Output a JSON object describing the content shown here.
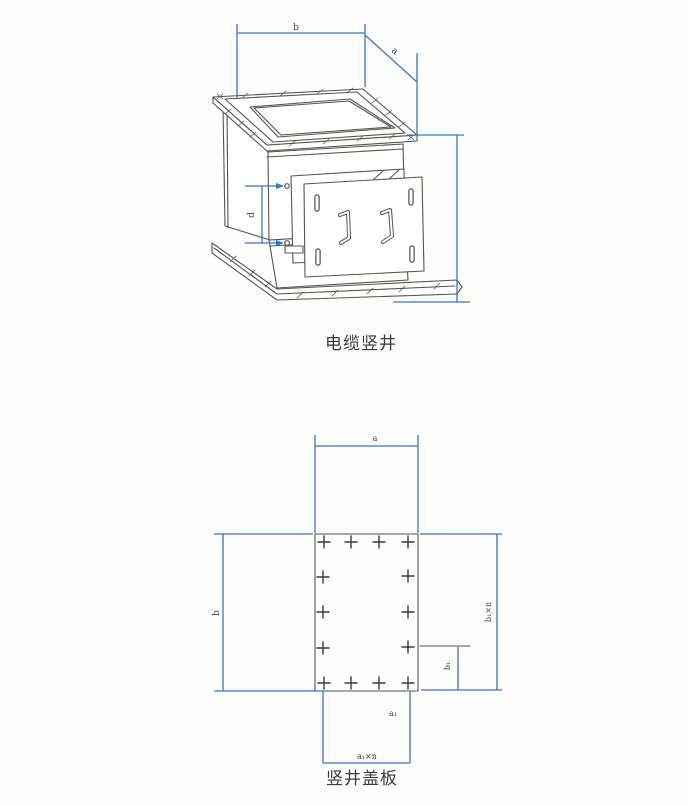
{
  "page": {
    "background": "#fdfdfb",
    "colors": {
      "dimension_blue": "#3578c8",
      "drawing_gray": "#56544f",
      "label_text": "#3e3e3c"
    }
  },
  "figure_top": {
    "caption": "电缆竖井",
    "dim_labels": {
      "top_width": "b",
      "top_depth": "a",
      "door_bolt_spacing": "d"
    }
  },
  "figure_bottom": {
    "caption": "竖井盖板",
    "dim_labels": {
      "top_width": "a",
      "left_height": "b",
      "right_height": "b₁×n",
      "right_offset": "b₁",
      "bottom_offset": "a₁",
      "bottom_width": "a₁×n"
    },
    "bolt_crosses": [
      [
        324,
        542
      ],
      [
        351,
        542
      ],
      [
        379,
        542
      ],
      [
        408,
        542
      ],
      [
        323,
        577
      ],
      [
        408,
        576
      ],
      [
        323,
        612
      ],
      [
        408,
        612
      ],
      [
        323,
        648
      ],
      [
        408,
        647
      ],
      [
        324,
        683
      ],
      [
        351,
        683
      ],
      [
        379,
        683
      ],
      [
        408,
        683
      ]
    ]
  }
}
